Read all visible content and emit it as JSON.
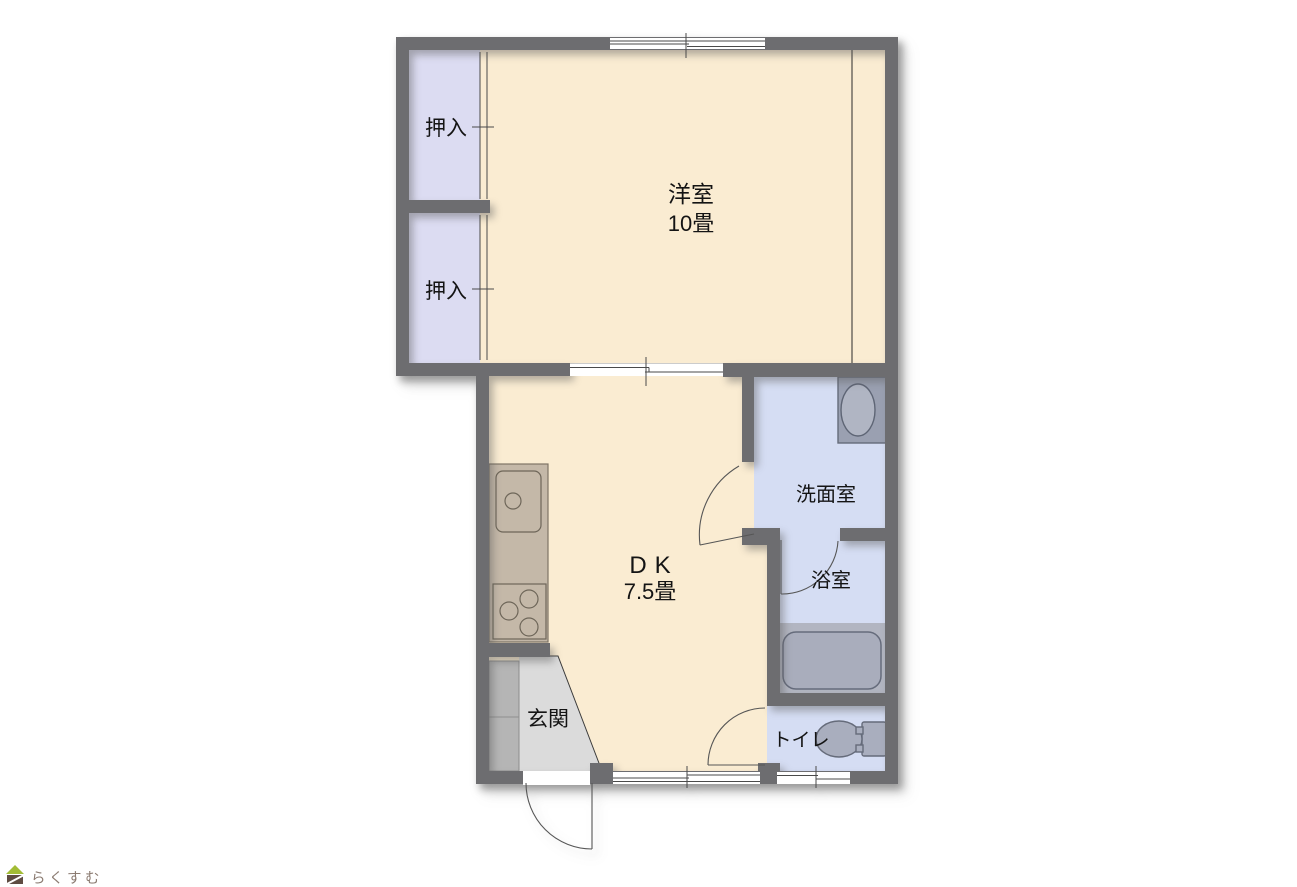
{
  "palette": {
    "wall": "#6d6d70",
    "room_floor": "#faecd2",
    "closet_floor": "#dcdcf2",
    "wet_area_floor": "#d5ddf3",
    "genkan_floor": "#dbdbdb",
    "shoe_cabinet": "#b5b5b5",
    "kitchen_counter": "#c4b8a8",
    "fixture_gray": "#a9aebe",
    "tub_platform": "#b2b5c1",
    "logo_green": "#a2bc35",
    "logo_brown": "#5e4c42"
  },
  "rooms": {
    "yoshitsu": {
      "label": "洋室",
      "size": "10畳"
    },
    "dk": {
      "label": "DK",
      "size": "7.5畳"
    },
    "oshiire_top": {
      "label": "押入"
    },
    "oshiire_bottom": {
      "label": "押入"
    },
    "senmen": {
      "label": "洗面室"
    },
    "yokushitsu": {
      "label": "浴室"
    },
    "toilet": {
      "label": "トイレ"
    },
    "genkan": {
      "label": "玄関"
    }
  },
  "logo": {
    "text": "らくすむ"
  }
}
